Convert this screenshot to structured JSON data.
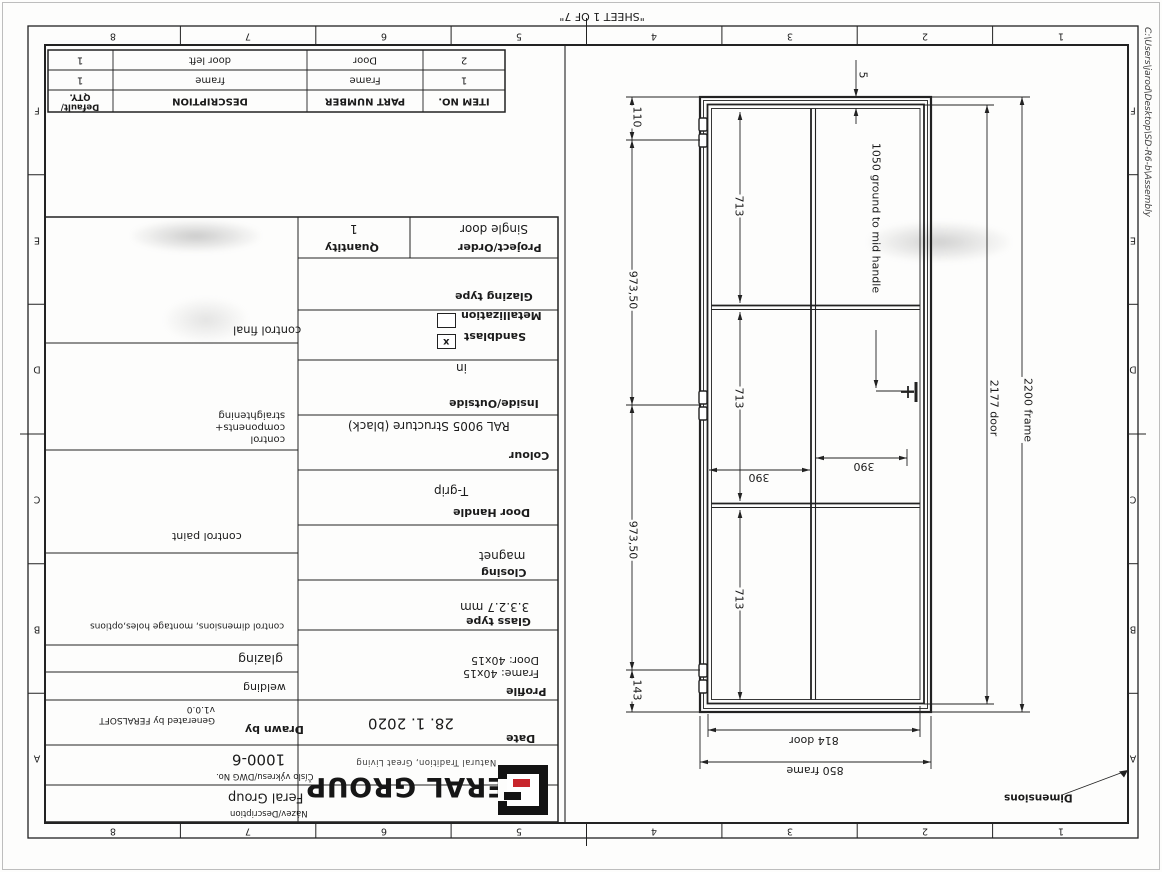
{
  "page": {
    "sheet_note": "\"SHEET 1 OF 7\"",
    "file_path": "C:\\Users\\jarod\\Desktop\\SD-R6-b\\Assembly"
  },
  "zones": {
    "numbers": [
      "1",
      "2",
      "3",
      "4",
      "5",
      "6",
      "7",
      "8"
    ],
    "letters": [
      "A",
      "B",
      "C",
      "D",
      "E",
      "F"
    ]
  },
  "bom": {
    "headers": {
      "item": "ITEM NO.",
      "part": "PART NUMBER",
      "desc": "DESCRIPTION",
      "qty": "Default/\nQTY."
    },
    "rows": [
      {
        "item": "1",
        "part": "Frame",
        "desc": "frame",
        "qty": "1"
      },
      {
        "item": "2",
        "part": "Door",
        "desc": "door left",
        "qty": "1"
      }
    ]
  },
  "order": {
    "project_label": "Project/Order",
    "project": "Single door",
    "qty_label": "Quantity",
    "qty": "1"
  },
  "specs": {
    "glazing_type_label": "Glazing type",
    "sandblast_label": "Sandblast",
    "sandblast_mark": "x",
    "metallization_label": "Metallization",
    "inside_outside_label": "Inside/Outside",
    "inside_outside": "in",
    "colour_label": "Colour",
    "colour": "RAL 9005 Structure (black)",
    "door_handle_label": "Door Handle",
    "door_handle": "T-grip",
    "closing_label": "Closing",
    "closing": "magnet",
    "glass_type_label": "Glass type",
    "glass_type": "3.3.2.7 mm",
    "profile_label": "Profile",
    "profile": "Frame: 40x15\nDoor: 40x15"
  },
  "controls": {
    "final": "control final",
    "components": "control\ncomponents+\nstraightening",
    "paint": "control paint",
    "dimensions": "control dimensions, montage holes,options",
    "glazing": "glazing",
    "welding": "welding"
  },
  "title": {
    "date_label": "Date",
    "date": "28. 1. 2020",
    "drawn_by_label": "Drawn by",
    "drawn_by": "Generated by FERALSOFT\nv1.0.0",
    "dwg_label": "Číslo výkresu/DWG No.",
    "dwg_no": "1000-6",
    "desc_label": "Název/Description",
    "description": "Feral Group",
    "brand": "FERAL GROUP",
    "tagline": "Natural Tradition, Great Living"
  },
  "dims": {
    "hinge_top": "110",
    "hinge_mid1": "973,50",
    "hinge_mid2": "973,50",
    "hinge_bot": "143",
    "panels": [
      "713",
      "713",
      "713"
    ],
    "glass_w_left": "390",
    "glass_w_right": "390",
    "door_w": "814 door",
    "frame_w": "850 frame",
    "door_h": "2177 door",
    "frame_h": "2200 frame",
    "gap": "5",
    "handle_note": "1050 ground to mid handle",
    "note": "Dimensions"
  },
  "colors": {
    "line": "#222222",
    "logo_red": "#c8252c"
  }
}
